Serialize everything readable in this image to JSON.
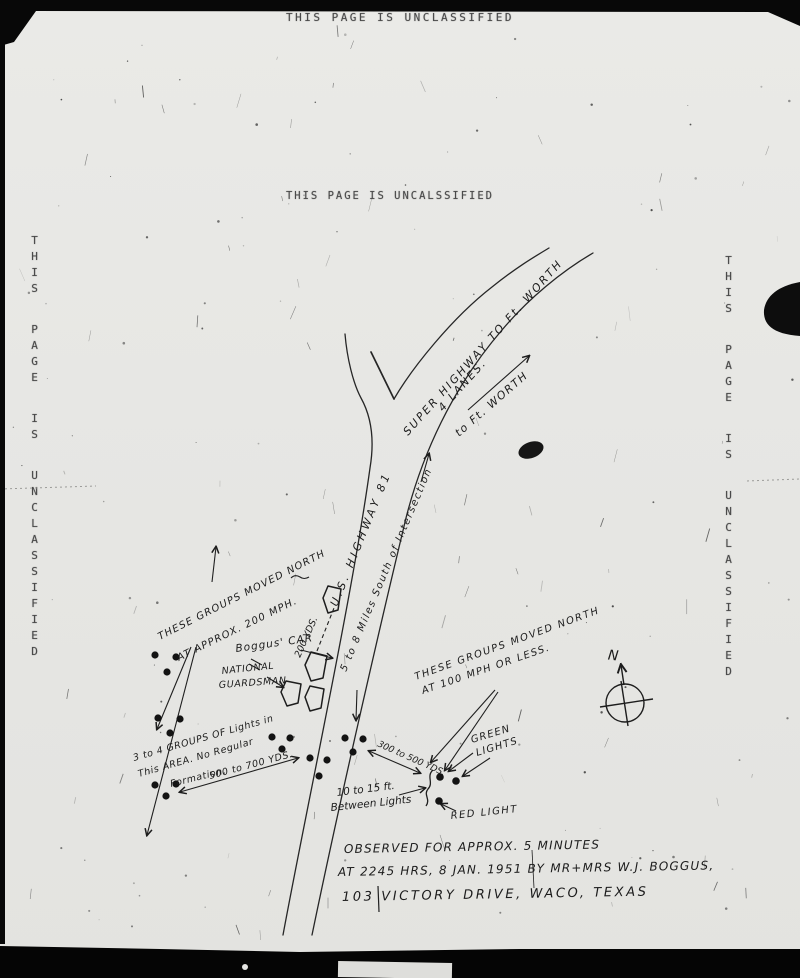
{
  "colors": {
    "ink": "#1c1c1c",
    "paper": "#e8e8e5",
    "typed_text": "#4a4a4a"
  },
  "banners": {
    "top": "THIS PAGE IS UNCLASSIFIED",
    "center": "THIS PAGE IS UNCALSSIFIED",
    "left_margin": "THIS PAGE IS UNCLASSIFIED",
    "right_margin": "THIS PAGE IS UNCLASSIFIED"
  },
  "map": {
    "highway_labels": {
      "super_highway": "SUPER HIGHWAY TO Ft. WORTH",
      "lanes": "4 LANES.",
      "to_ft_worth": "to Ft. WORTH",
      "us_highway_81": "U.S. HIGHWAY 81",
      "miles_south": "5 to 8 Miles South of Intersection"
    },
    "annotations": {
      "groups_fast_line1": "THESE GROUPS MOVED NORTH",
      "groups_fast_line2": "AT APPROX. 200 MPH.",
      "yds_200": "200 YDS.",
      "boggus_car": "Boggus' CAR",
      "national": "NATIONAL",
      "guardsman": "GUARDSMAN",
      "area_line1": "3 to 4 GROUPS OF Lights in",
      "area_line2": "This AREA. No Regular",
      "area_line3": "Formation.",
      "yds_500_700": "500 to 700 YDS.",
      "groups_slow_line1": "THESE GROUPS MOVED NORTH",
      "groups_slow_line2": "AT 100 MPH OR LESS.",
      "yds_300_500": "300 to 500 YDS.",
      "green_line1": "GREEN",
      "green_line2": "LIGHTS",
      "red_light": "RED LIGHT",
      "between_line1": "10 to 15 ft.",
      "between_line2": "Between Lights"
    },
    "compass": {
      "north": "N"
    },
    "caption": [
      "OBSERVED FOR APPROX. 5 MINUTES",
      "AT 2245 HRS, 8 JAN. 1951 BY MR+MRS W.J. BOGGUS,",
      "103 VICTORY DRIVE, WACO, TEXAS"
    ]
  }
}
